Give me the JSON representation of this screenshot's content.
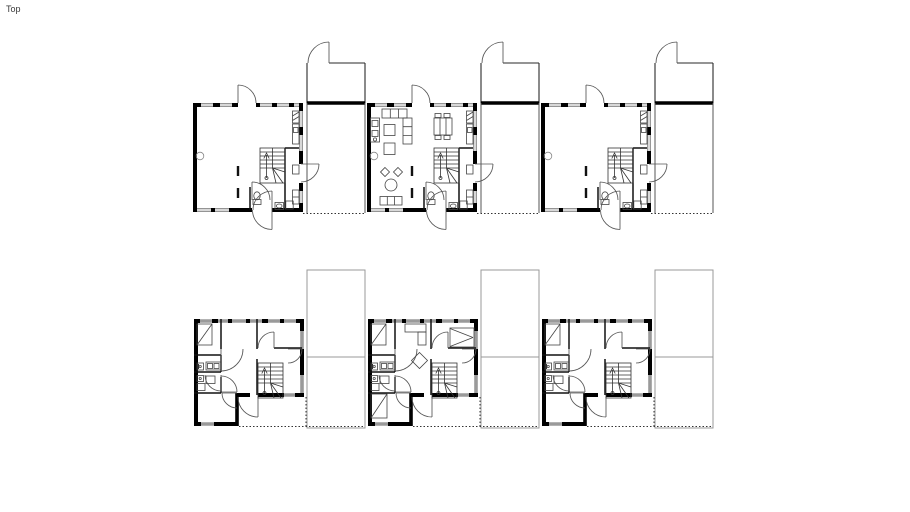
{
  "viewport": {
    "label": "Top"
  },
  "drawing": {
    "type": "floor-plan",
    "rows": [
      {
        "name": "ground-floor",
        "units": [
          "ground-floor-unit-1",
          "ground-floor-unit-2-furnished",
          "ground-floor-unit-3"
        ],
        "carports": [
          "carport-1",
          "carport-2",
          "carport-3"
        ]
      },
      {
        "name": "upper-floor",
        "units": [
          "upper-floor-unit-1",
          "upper-floor-unit-2-furnished",
          "upper-floor-unit-3"
        ],
        "carport_roofs": [
          "carport-roof-1",
          "carport-roof-2",
          "carport-roof-3"
        ]
      }
    ],
    "colors": {
      "background": "#ffffff",
      "walls": "#000000",
      "window_band": "#d8d8d8",
      "upper_window_band": "#9a9a9a",
      "fixtures": "#444444",
      "door_arcs": "#555555",
      "roof_outline": "#999999",
      "dotted_lines": "#333333",
      "label": "#3a3a3a"
    }
  }
}
